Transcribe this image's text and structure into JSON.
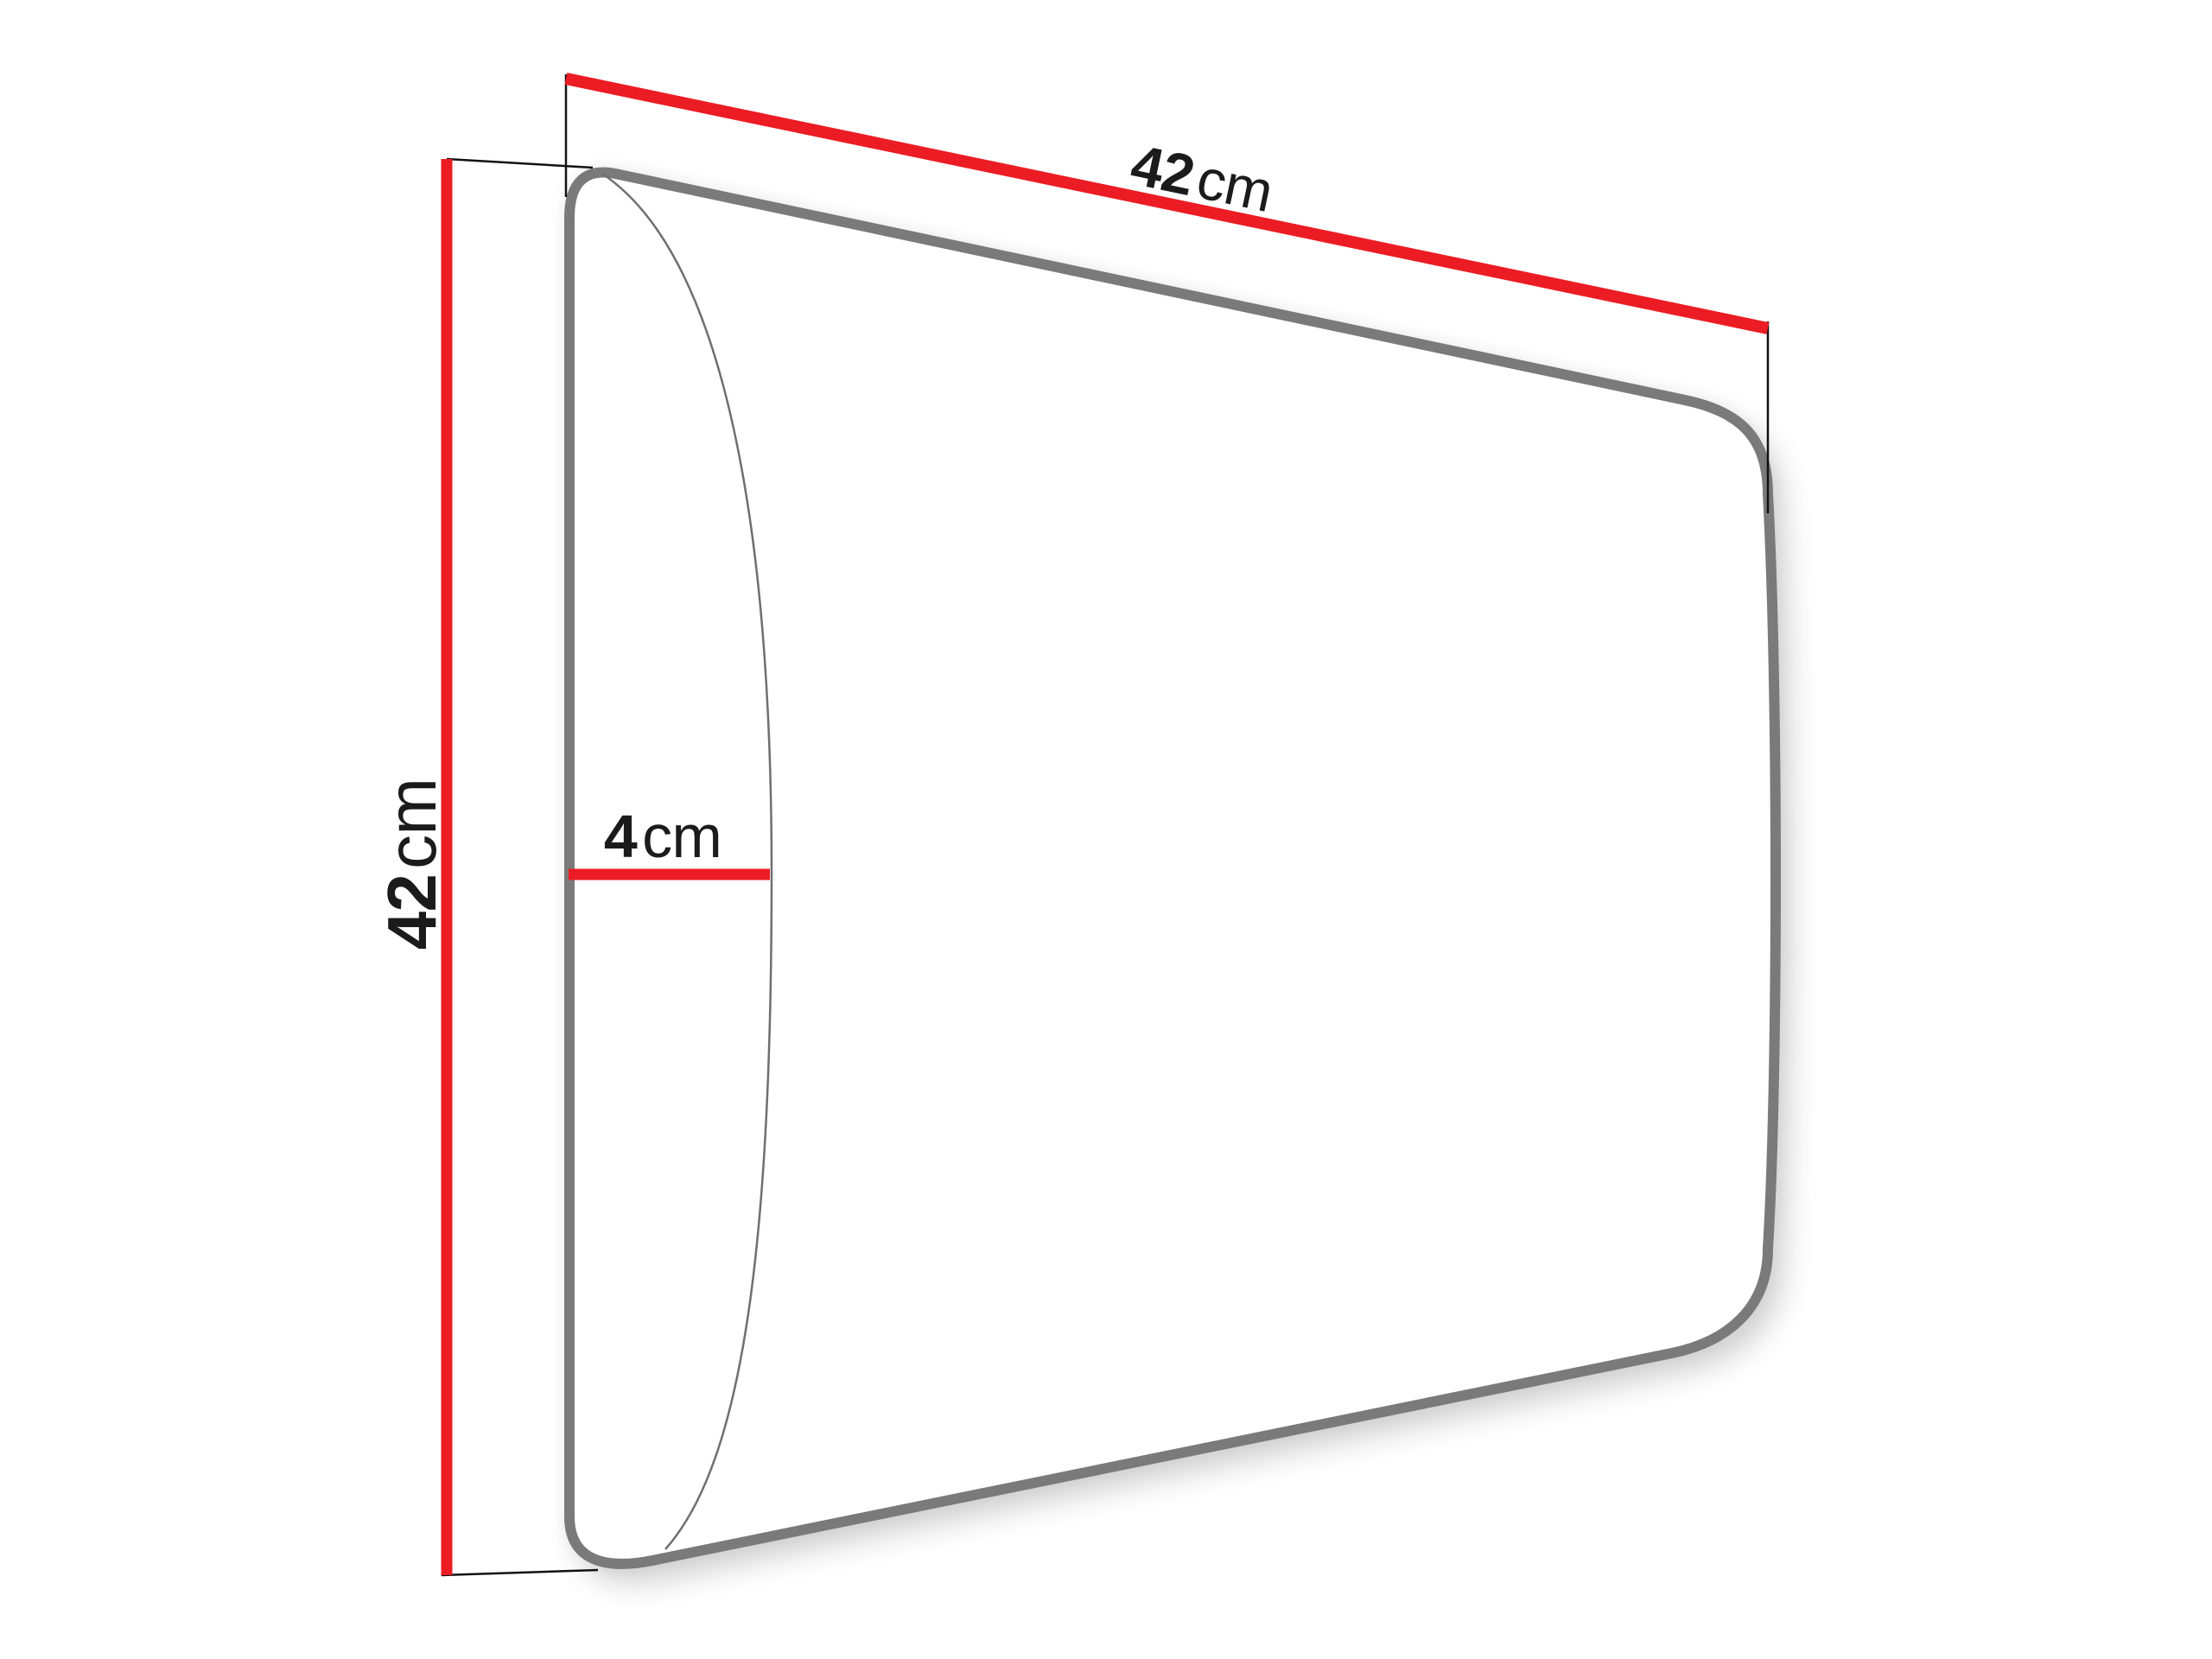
{
  "diagram": {
    "kind": "furniture-panel-dimension-drawing",
    "background": "#ffffff",
    "colors": {
      "dimension_line": "#ec1c24",
      "panel_outline": "#7a7a7a",
      "panel_fill": "#ffffff",
      "front_edge_curve": "#6f6f6f",
      "extension_line": "#121212",
      "label_text": "#1b1b1b"
    },
    "labels": {
      "width": {
        "value": "42",
        "unit": "cm"
      },
      "height": {
        "value": "42",
        "unit": "cm"
      },
      "depth": {
        "value": "4",
        "unit": "cm"
      }
    }
  }
}
